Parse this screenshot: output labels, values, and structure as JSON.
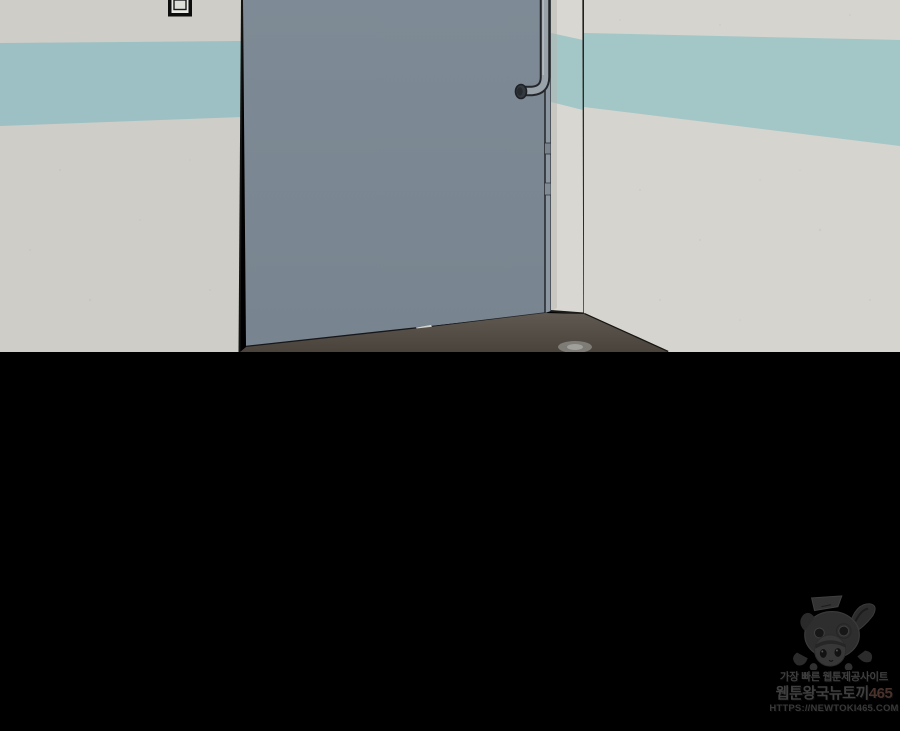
{
  "scene": {
    "description": "Corridor corner with a closed gray door, cream walls with a teal accent stripe, grab handle on the door, dark floor; lower two-thirds of the panel is black letterbox"
  },
  "colors": {
    "wall-left": "#cecdc8",
    "wall-right": "#d5d4ce",
    "wall-jamb": "#d8d7d1",
    "stripe-left": "#9cc0c3",
    "stripe-right": "#a3c6c7",
    "door": "#7d8994",
    "door-edge": "#8c96a0",
    "handle": "#99a2a9",
    "handle-outline": "#23262b",
    "floor": "#57514a",
    "outline-dark": "#17161a",
    "letterbox": "#000000",
    "watermark-text": "#3f3f3f",
    "watermark-number": "#4a322c",
    "watermark-url": "#383838"
  },
  "watermark": {
    "tagline": "가장 빠른 웹툰제공사이트",
    "site_name": "웹툰왕국뉴토끼",
    "site_number": "465",
    "url": "HTTPS://NEWTOKI465.COM",
    "mascot": "bunny-hood-girl"
  }
}
